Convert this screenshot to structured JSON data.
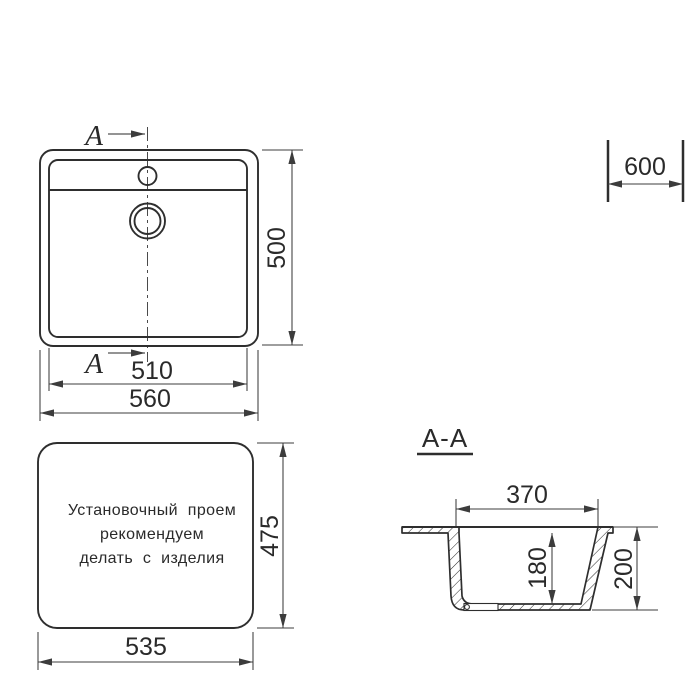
{
  "drawing": {
    "colors": {
      "line": "#2e2e2e",
      "dim": "#3c3c3c",
      "text": "#2a2a2a",
      "bg": "#ffffff"
    },
    "top_view": {
      "cut_letter": "A",
      "height": "500",
      "inner_width": "510",
      "outer_width": "560"
    },
    "cabinet": {
      "width": "600"
    },
    "install_view": {
      "note": [
        "Установочный проем",
        "рекомендуем",
        "делать с изделия"
      ],
      "height": "475",
      "width": "535"
    },
    "section_view": {
      "title": "A-A",
      "top_width": "370",
      "bowl_depth": "180",
      "overall_depth": "200"
    }
  }
}
